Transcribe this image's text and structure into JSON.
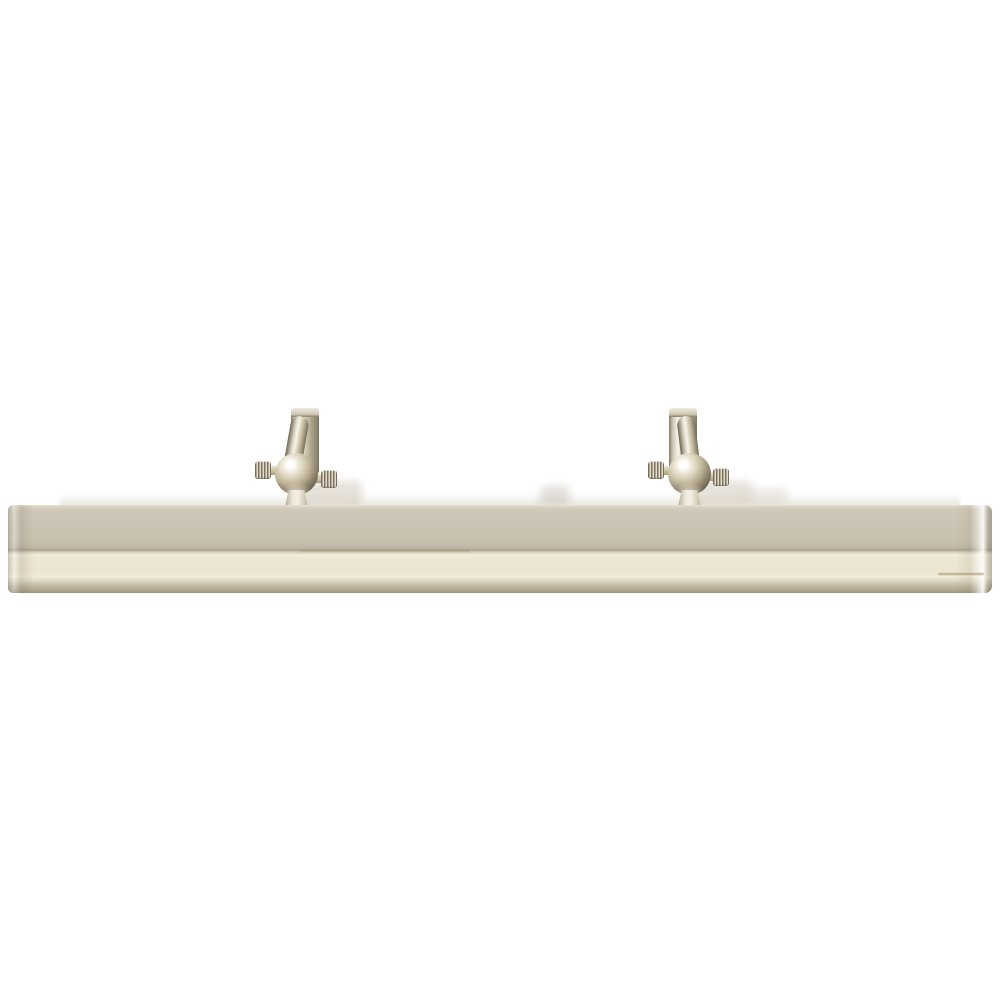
{
  "page": {
    "background_color": "#ffffff",
    "width": 1000,
    "height": 1000
  },
  "scene": {
    "description": "Product photo on a plain white background: a polished-nickel picture light seen straight on — a long horizontal half-round metal shade bar with two swivel mounting arms above it, each arm having a vertical bracket, an angled cylindrical stem, a polished ball joint and two knurled thumbscrews.",
    "object": "picture-light-fixture",
    "finish": "polished nickel",
    "palette": {
      "background": "#ffffff",
      "shade_top_edge": "#e6e0d2",
      "shade_upper_face": "#c8c1b0",
      "shade_crease_dark": "#aaa28d",
      "shade_crease_bright": "#f3eedd",
      "shade_lower_face": "#ece6d2",
      "shade_bottom_bevel": "#b0a790",
      "metal_highlight": "#fbfaf4",
      "metal_champagne": "#d6cbb2",
      "metal_mid": "#b0a68e",
      "metal_shadow": "#6e6557",
      "ball_core_shadow": "#483f32"
    },
    "parts": {
      "shade_bar": "horizontal half-round shade bar",
      "left_arm": "left swivel mounting arm",
      "right_arm": "right swivel mounting arm",
      "bracket": "vertical mounting bracket",
      "arm_cylinder": "angled cylindrical arm stem",
      "ball_joint": "polished ball swivel joint",
      "thumbscrew": "knurled adjustment thumbscrew",
      "yoke": "yoke stem joining ball to shade"
    }
  }
}
